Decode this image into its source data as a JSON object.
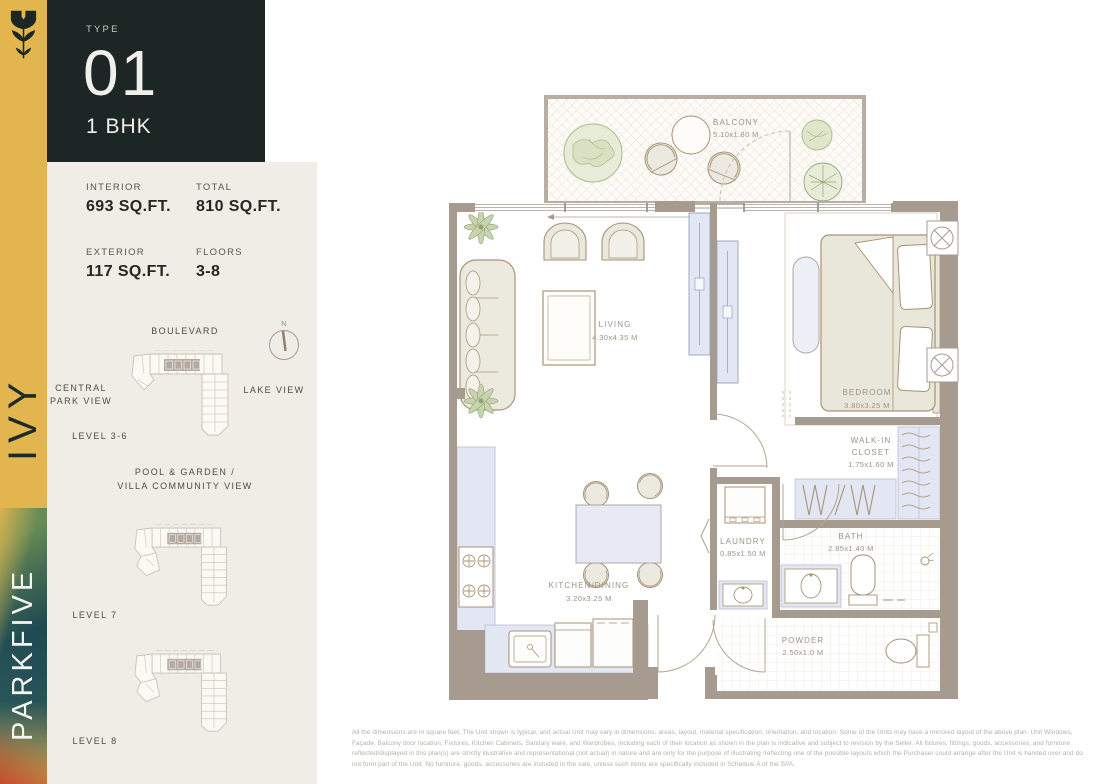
{
  "brand": {
    "project_name": "PARKFIVE",
    "tower_name": "IVY"
  },
  "unit_header": {
    "type_label": "TYPE",
    "type_number": "01",
    "bhk": "1 BHK"
  },
  "stats": {
    "interior": {
      "label": "INTERIOR",
      "value": "693 SQ.FT."
    },
    "total": {
      "label": "TOTAL",
      "value": "810 SQ.FT."
    },
    "exterior": {
      "label": "EXTERIOR",
      "value": "117 SQ.FT."
    },
    "floors": {
      "label": "FLOORS",
      "value": "3-8"
    }
  },
  "keyplan": {
    "compass_label": "N",
    "boulevard": "BOULEVARD",
    "central_park_line1": "CENTRAL",
    "central_park_line2": "PARK VIEW",
    "lake_view": "LAKE VIEW",
    "level_3_6": "LEVEL 3-6",
    "pool_line1": "POOL & GARDEN /",
    "pool_line2": "VILLA COMMUNITY VIEW",
    "level_7": "LEVEL 7",
    "level_8": "LEVEL 8"
  },
  "floorplan": {
    "balcony": {
      "name": "BALCONY",
      "dims": "5.10x1.80 M"
    },
    "living": {
      "name": "LIVING",
      "dims": "4.30x4.35 M"
    },
    "bedroom": {
      "name": "BEDROOM",
      "dims": "3.80x3.25 M"
    },
    "walkin": {
      "name_line1": "WALK-IN",
      "name_line2": "CLOSET",
      "dims": "1.75x1.60 M"
    },
    "bath": {
      "name": "BATH",
      "dims": "2.85x1.40 M"
    },
    "laundry": {
      "name": "LAUNDRY",
      "dims": "0.85x1.50 M"
    },
    "kitchen": {
      "name": "KITCHEN/DINING",
      "dims": "3.20x3.25 M"
    },
    "powder": {
      "name": "POWDER",
      "dims": "2.50x1.0 M"
    }
  },
  "disclaimer": {
    "text": "All the dimensions are in square feet. The Unit shown is typical, and actual Unit may vary in dimensions, areas, layout, material specification, orientation, and location. Some of the Units may have a mirrored layout of the above plan. Unit Windows, Façade, Balcony door location, Fixtures, Kitchen Cabinets, Sanitary ware, and Wardrobes, including each of their location as shown in the plan is indicative and subject to revision by the Seller. All fixtures, fittings, goods, accessories, and furniture reflected/displayed in this plan(s) are strictly illustrative and representational (not actual) in nature and are only for the purpose of illustrating /reflecting one of the possible layouts which the Purchaser could arrange after the Unit is handed over and do not form part of the Unit. No furniture, goods, accessories are included in the sale, unless such items are specifically included in Schedule A of the SPA."
  },
  "colors": {
    "gold": "#e3b54e",
    "dark_panel": "#1b2625",
    "beige_panel": "#f0ede6",
    "wall": "#a79b8f",
    "fixture_blue": "#e3e7f3",
    "foliage": "#c9d3ae",
    "label": "#9c9285"
  }
}
